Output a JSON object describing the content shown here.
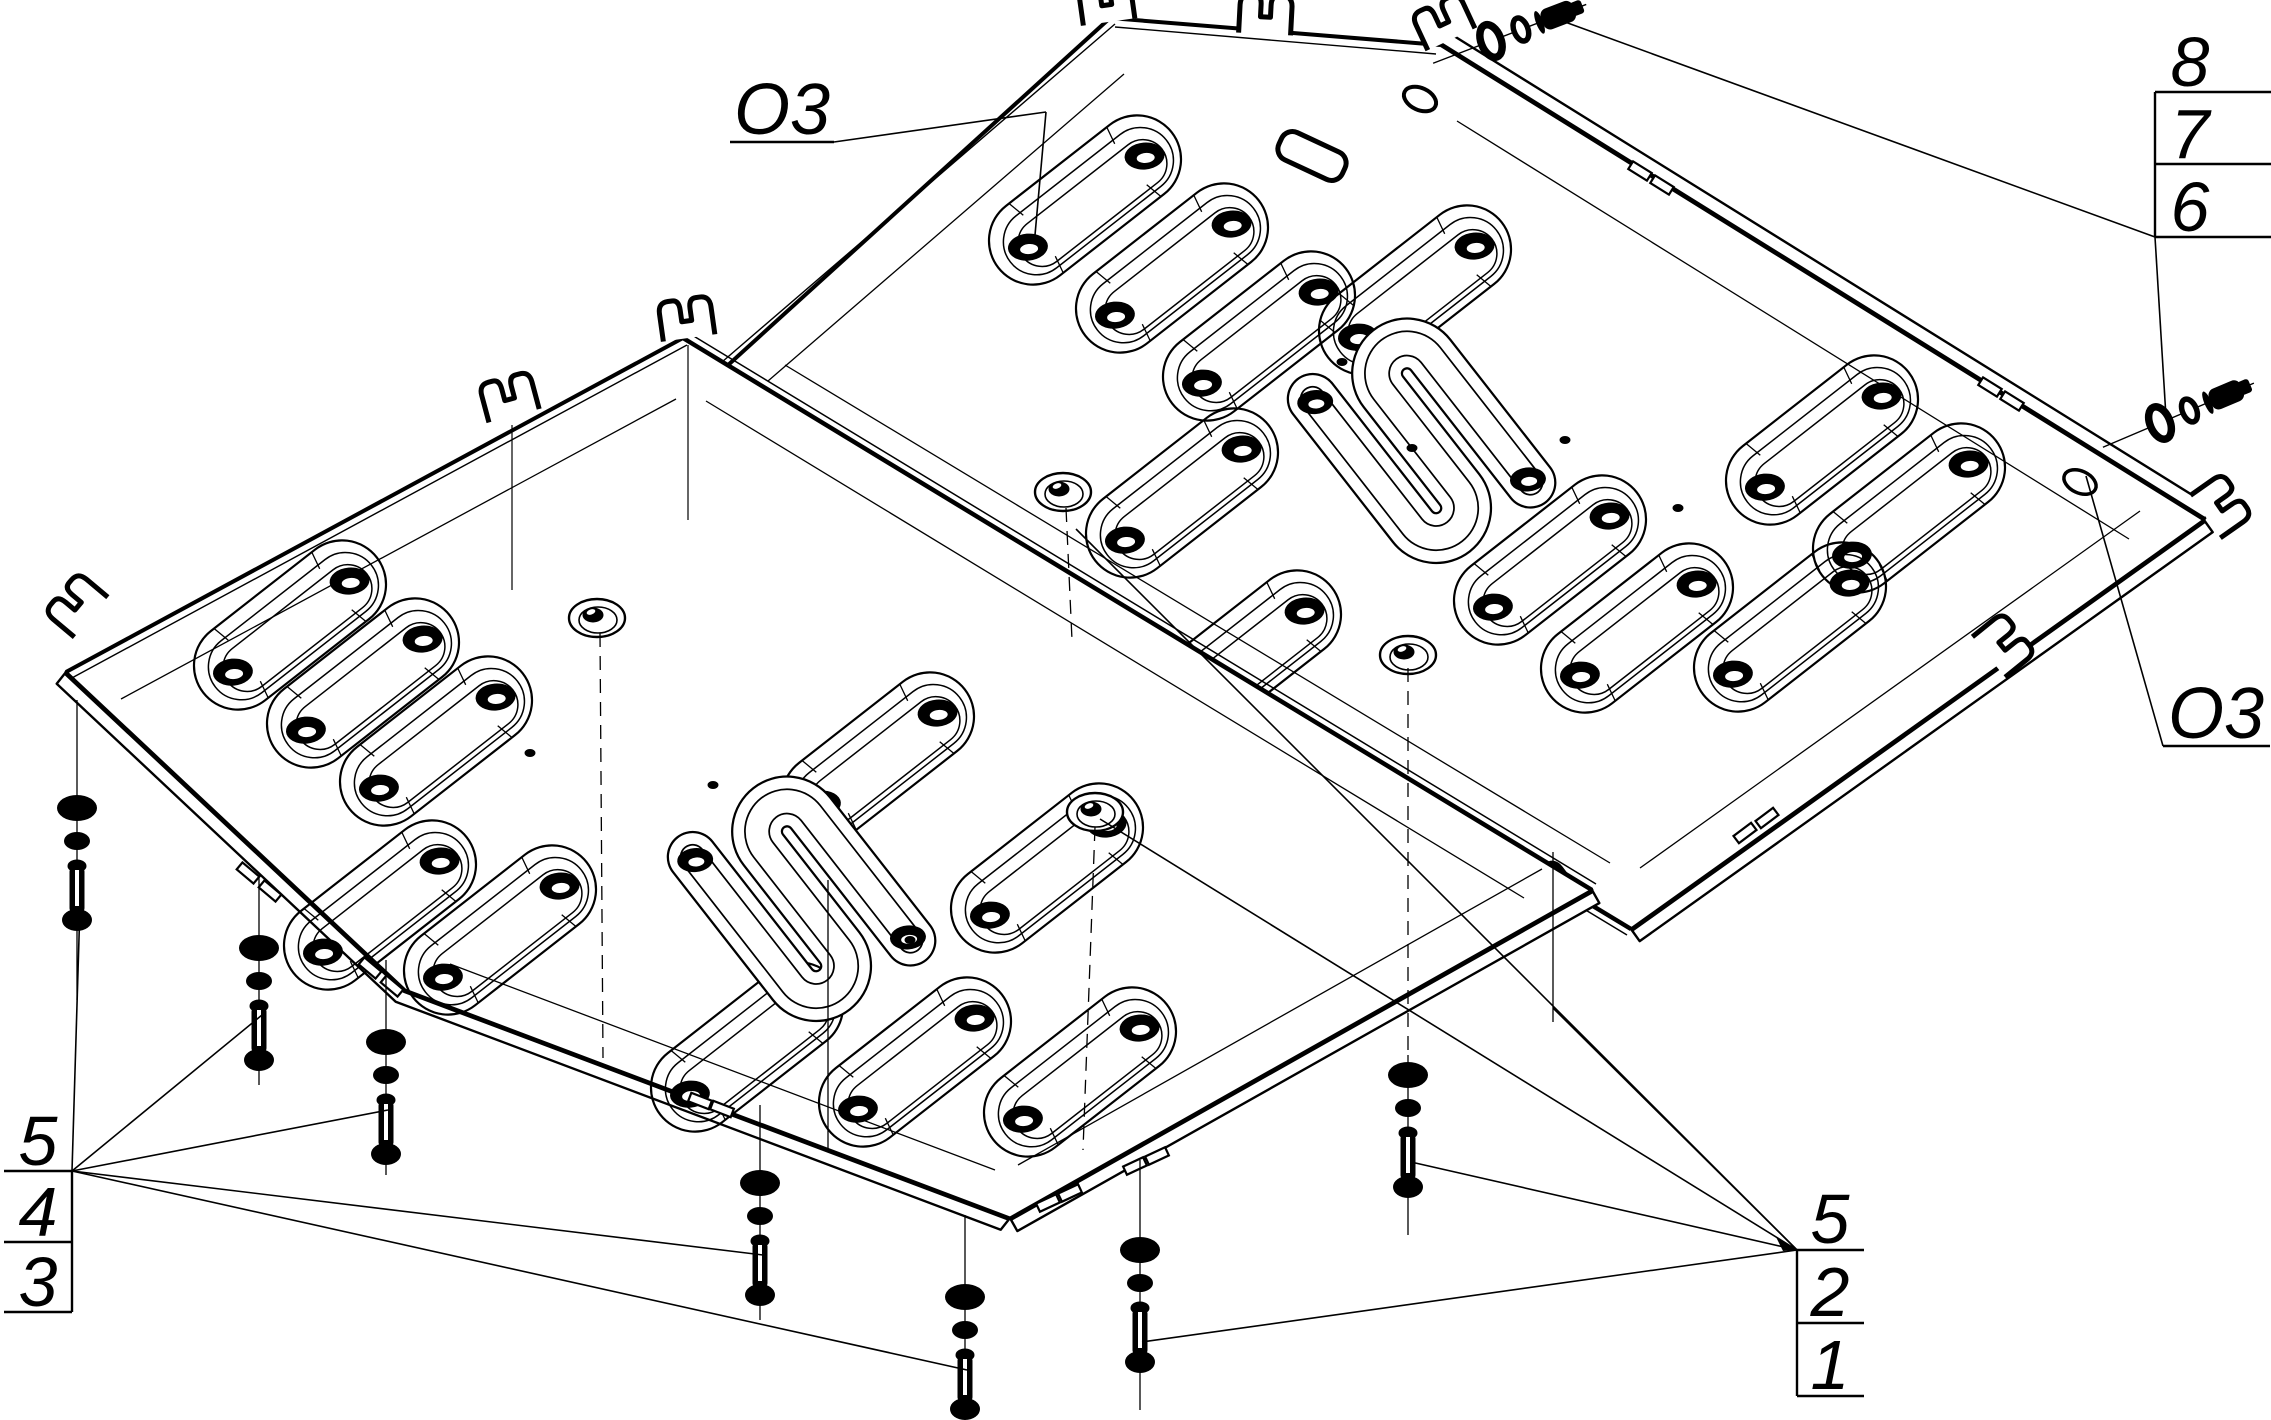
{
  "drawing": {
    "background": "#ffffff",
    "ink": "#000000",
    "callouts": {
      "hole_top": "O3",
      "hole_right": "O3",
      "top_right_rows": [
        "8",
        "7",
        "6"
      ],
      "bottom_left_rows": [
        "5",
        "4",
        "3"
      ],
      "bottom_right_rows": [
        "5",
        "2",
        "1"
      ]
    },
    "icons": {
      "rear_plate": "skid-plate-rear-section",
      "front_plate": "skid-plate-front-section",
      "bolt": "hex-bolt-icon",
      "flat_washer": "flat-washer-icon",
      "spring_washer": "spring-washer-icon",
      "dome_hole": "dome-mount-hole-icon",
      "slot": "stamped-oblong-slot-icon",
      "meander": "stamped-meander-channel-icon",
      "tab": "mounting-fork-tab-icon"
    }
  }
}
